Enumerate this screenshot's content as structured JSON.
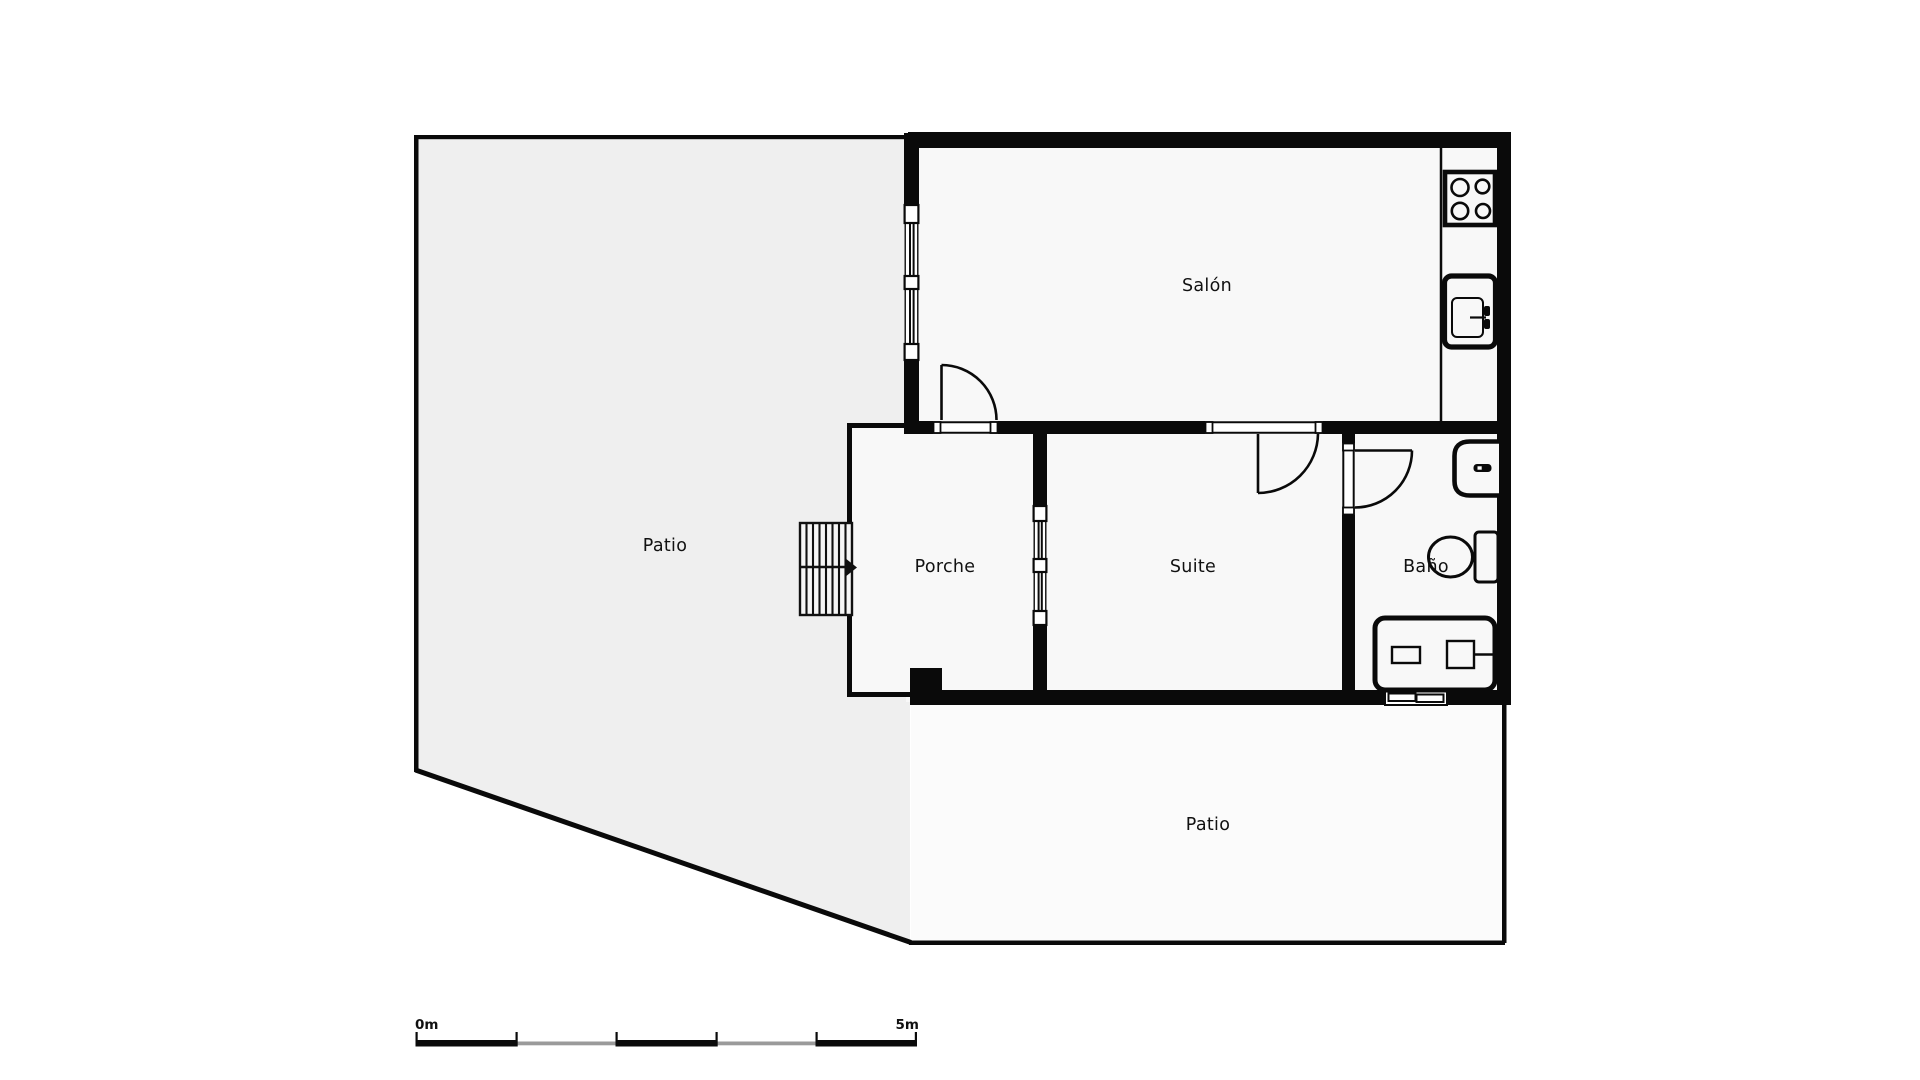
{
  "plan": {
    "rooms": {
      "salon": {
        "label": "Salón"
      },
      "patio_left": {
        "label": "Patio"
      },
      "porche": {
        "label": "Porche"
      },
      "suite": {
        "label": "Suite"
      },
      "bano": {
        "label": "Baño"
      },
      "patio_bottom": {
        "label": "Patio"
      }
    },
    "fixtures": [
      "stove-icon",
      "kitchen-sink-icon",
      "washbasin-icon",
      "toilet-icon",
      "bathtub-icon",
      "stairs-icon"
    ],
    "scale_bar": {
      "start_label": "0m",
      "end_label": "5m"
    },
    "colors": {
      "wall": "#0a0a0a",
      "patio_fill": "#efefef",
      "room_fill": "#f8f8f8",
      "patio_bottom_fill": "#fbfbfb",
      "scale_gray": "#9a9a9a",
      "text": "#111111"
    }
  }
}
